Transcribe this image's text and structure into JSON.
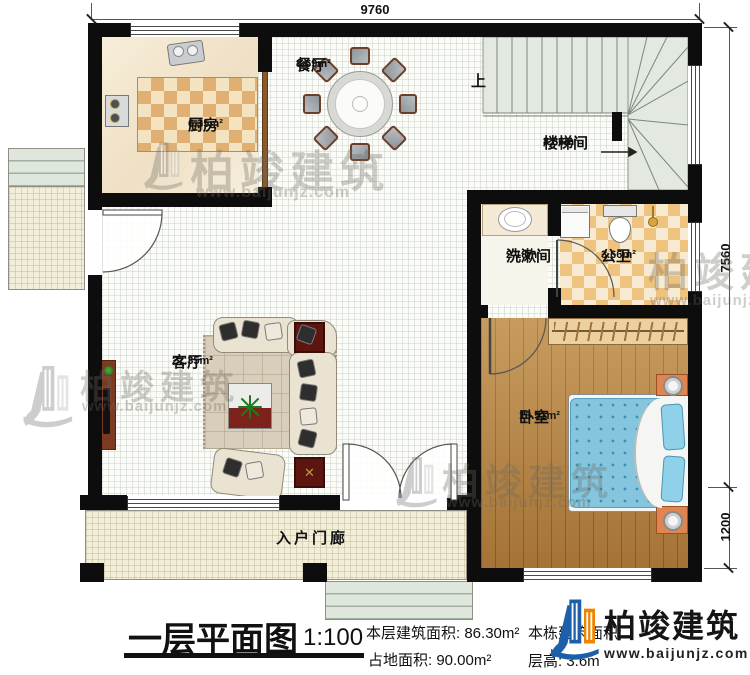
{
  "plan": {
    "rooms": {
      "dining": {
        "name": "餐厅",
        "area": "8.69m²"
      },
      "kitchen": {
        "name": "厨房",
        "area": "6.35m²"
      },
      "stair": {
        "name": "楼梯间",
        "area": "8.86m²"
      },
      "wash": {
        "name": "洗漱间",
        "area": "2.18m²"
      },
      "bath": {
        "name": "公卫",
        "area": "3.66m²"
      },
      "living": {
        "name": "客厅",
        "area": "27.35m²"
      },
      "bedroom": {
        "name": "卧室",
        "area": "13.51m²"
      },
      "porch": {
        "name": "入户门廊"
      }
    },
    "stair_up_label": "上",
    "dimensions": {
      "top": "9760",
      "right_upper": "7560",
      "right_lower": "1200"
    }
  },
  "titleblock": {
    "title": "一层平面图",
    "scale": "1:100",
    "floor_area": "本层建筑面积: 86.30m²",
    "site_area": "占地面积: 90.00m²",
    "building_area_partial": "本栋建筑面积:",
    "floor_height": "层高: 3.6m"
  },
  "brand": {
    "name": "柏竣建筑",
    "site": "www.baijunjz.com"
  }
}
